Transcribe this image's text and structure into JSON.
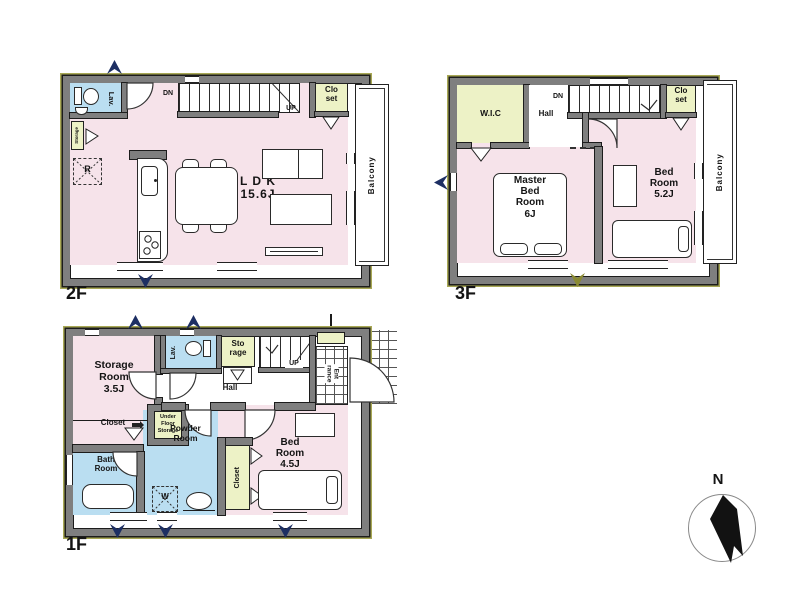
{
  "document": {
    "type": "house-floor-plan"
  },
  "colors": {
    "room_pink": "#f6e3ea",
    "room_blue": "#badef1",
    "room_green": "#edf2c6",
    "wall_gray": "#7f7f7f",
    "outline_black": "#1c1c1c",
    "exterior_olive": "#a8a855",
    "arrow_navy": "#1d2f63",
    "arrow_olive": "#8a8a33"
  },
  "floor2": {
    "name": "2F",
    "ldk": "L D K\n15.6J",
    "lav": "Lav.",
    "storage": "Storage",
    "closet": "Clo\nset",
    "balcony": "Balcony",
    "dn": "DN",
    "up": "UP",
    "fridge": "R"
  },
  "floor3": {
    "name": "3F",
    "wic": "W.I.C",
    "hall": "Hall",
    "dn": "DN",
    "closet": "Clo\nset",
    "balcony": "Balcony",
    "master_bedroom": "Master\nBed\nRoom\n6J",
    "bedroom": "Bed\nRoom\n5.2J"
  },
  "floor1": {
    "name": "1F",
    "storage_room": "Storage\nRoom\n3.5J",
    "lav": "Lav.",
    "storage": "Sto\nrage",
    "up": "UP",
    "hall": "Hall",
    "entrance": "Ent\nrance",
    "closet_label": "Closet",
    "under_floor_storage": "Under\nFloor\nStorage",
    "bath_room": "Bath\nRoom",
    "powder_room": "Powder\nRoom",
    "washer": "W",
    "closet_side": "Closet",
    "bedroom": "Bed\nRoom\n4.5J"
  },
  "compass": {
    "north": "N"
  }
}
